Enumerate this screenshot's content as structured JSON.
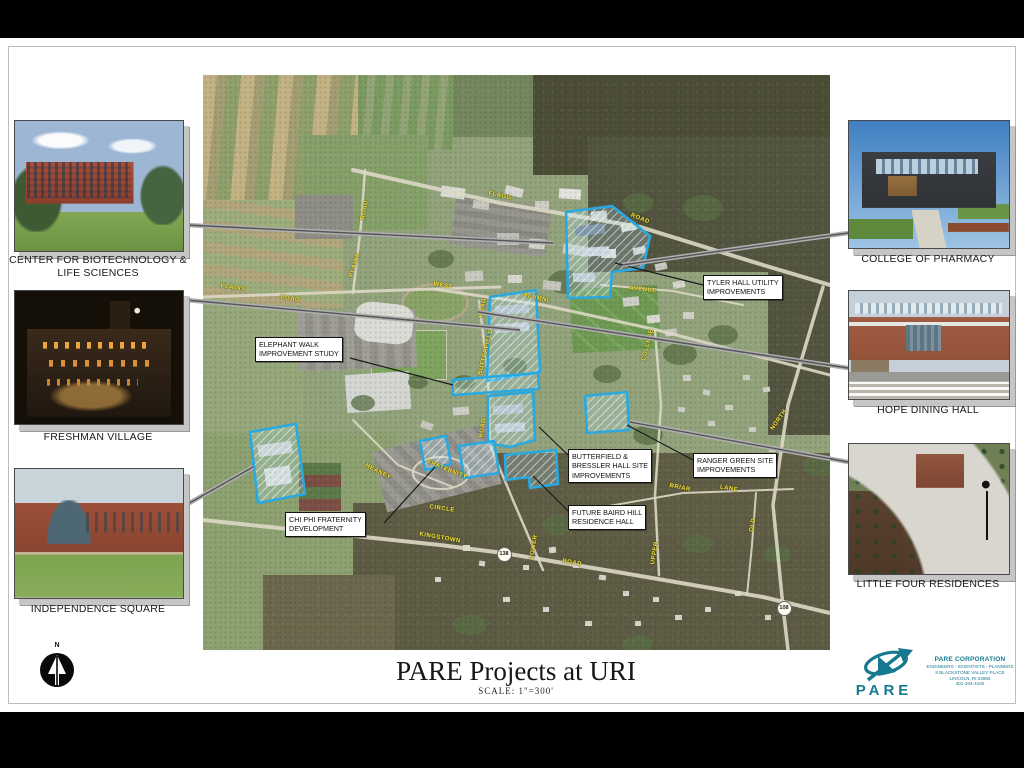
{
  "poster": {
    "title": "PARE Projects at URI",
    "scale_note": "SCALE: 1\"=300'"
  },
  "north_arrow": {
    "label": "N"
  },
  "brand": {
    "name": "PARE",
    "company": "PARE CORPORATION",
    "tagline": "ENGINEERS - SCIENTISTS - PLANNERS",
    "address": "8 BLACKSTONE VALLEY PLACE",
    "city": "LINCOLN, RI 02865",
    "phone": "401-334-4100",
    "color": "#17798f"
  },
  "photos": [
    {
      "id": "biotech",
      "caption": "CENTER FOR BIOTECHNOLOGY & LIFE SCIENCES",
      "x": 14,
      "y": 120,
      "w": 168,
      "h": 130,
      "cy": 254
    },
    {
      "id": "freshman",
      "caption": "FRESHMAN VILLAGE",
      "x": 14,
      "y": 290,
      "w": 168,
      "h": 133,
      "cy": 431
    },
    {
      "id": "independence",
      "caption": "INDEPENDENCE SQUARE",
      "x": 14,
      "y": 468,
      "w": 168,
      "h": 129,
      "cy": 603
    },
    {
      "id": "pharmacy",
      "caption": "COLLEGE OF PHARMACY",
      "x": 848,
      "y": 120,
      "w": 160,
      "h": 127,
      "cy": 253
    },
    {
      "id": "hope",
      "caption": "HOPE DINING HALL",
      "x": 848,
      "y": 290,
      "w": 160,
      "h": 108,
      "cy": 404
    },
    {
      "id": "littlefour",
      "caption": "LITTLE FOUR RESIDENCES",
      "x": 848,
      "y": 443,
      "w": 160,
      "h": 130,
      "cy": 578
    }
  ],
  "map": {
    "x": 203,
    "y": 75,
    "w": 627,
    "h": 575,
    "site_color": "#2aa9e1",
    "sites": [
      {
        "name": "tyler-hall-site",
        "points": "363,137 409,131 447,161 440,193 409,197 407,222 365,223"
      },
      {
        "name": "quad-site",
        "points": "287,222 333,215 337,297 284,306"
      },
      {
        "name": "elephant-walk-strip-site",
        "points": "249,305 335,298 336,314 250,320"
      },
      {
        "name": "butterfield-bressler-site",
        "points": "285,321 330,317 332,365 307,372 285,368"
      },
      {
        "name": "ranger-green-site",
        "points": "382,321 424,317 426,355 384,358"
      },
      {
        "name": "independence-square-site",
        "points": "47,357 93,349 102,419 55,428"
      },
      {
        "name": "chi-phi-site",
        "points": "217,366 243,361 248,389 222,395"
      },
      {
        "name": "small-site-east",
        "points": "256,371 291,366 296,398 261,403"
      },
      {
        "name": "baird-hill-site",
        "points": "302,380 353,375 355,409 327,413 326,402 303,405"
      }
    ],
    "callouts": [
      {
        "id": "tyler-hall",
        "x": 500,
        "y": 200,
        "lines": [
          "TYLER HALL UTILITY",
          "IMPROVEMENTS"
        ],
        "leader": [
          500,
          210,
          412,
          188
        ]
      },
      {
        "id": "elephant-walk",
        "x": 52,
        "y": 262,
        "lines": [
          "ELEPHANT WALK",
          "IMPROVEMENT STUDY"
        ],
        "leader": [
          147,
          283,
          250,
          310
        ]
      },
      {
        "id": "butterfield-bressler",
        "x": 365,
        "y": 374,
        "lines": [
          "BUTTERFIELD &",
          "BRESSLER HALL SITE",
          "IMPROVEMENTS"
        ],
        "leader": [
          365,
          380,
          336,
          352
        ]
      },
      {
        "id": "ranger-green",
        "x": 490,
        "y": 378,
        "lines": [
          "RANGER GREEN SITE",
          "IMPROVEMENTS"
        ],
        "leader": [
          490,
          385,
          424,
          350
        ]
      },
      {
        "id": "future-baird-hill",
        "x": 365,
        "y": 430,
        "lines": [
          "FUTURE BAIRD HILL",
          "RESIDENCE HALL"
        ],
        "leader": [
          365,
          436,
          330,
          401
        ]
      },
      {
        "id": "chi-phi",
        "x": 82,
        "y": 437,
        "lines": [
          "CHI PHI FRATERNITY",
          "DEVELOPMENT"
        ],
        "leader": [
          181,
          448,
          232,
          392
        ]
      }
    ],
    "road_labels": [
      {
        "t": "FLAGG",
        "x": 297,
        "y": 121,
        "r": 12
      },
      {
        "t": "ROAD",
        "x": 437,
        "y": 144,
        "r": 22
      },
      {
        "t": "ROAD",
        "x": 162,
        "y": 135,
        "r": -78
      },
      {
        "t": "PLAINS",
        "x": 152,
        "y": 190,
        "r": -72
      },
      {
        "t": "PLAINS",
        "x": 30,
        "y": 213,
        "r": 8
      },
      {
        "t": "ROAD",
        "x": 87,
        "y": 224,
        "r": 8
      },
      {
        "t": "WEST",
        "x": 240,
        "y": 211,
        "r": 10
      },
      {
        "t": "ALUMNI",
        "x": 333,
        "y": 223,
        "r": 14
      },
      {
        "t": "ROAD",
        "x": 280,
        "y": 233,
        "r": -80
      },
      {
        "t": "AVENUE",
        "x": 440,
        "y": 215,
        "r": 6
      },
      {
        "t": "BUTTERFIELD",
        "x": 283,
        "y": 277,
        "r": -76
      },
      {
        "t": "COLLEGE",
        "x": 445,
        "y": 270,
        "r": -75
      },
      {
        "t": "ROAD",
        "x": 280,
        "y": 353,
        "r": -80
      },
      {
        "t": "HEANEY",
        "x": 175,
        "y": 397,
        "r": 28
      },
      {
        "t": "FRATERNITY",
        "x": 244,
        "y": 395,
        "r": 22
      },
      {
        "t": "CIRCLE",
        "x": 239,
        "y": 434,
        "r": 8
      },
      {
        "t": "KINGSTOWN",
        "x": 237,
        "y": 463,
        "r": 10
      },
      {
        "t": "ROAD",
        "x": 369,
        "y": 488,
        "r": 10
      },
      {
        "t": "LOWER",
        "x": 331,
        "y": 472,
        "r": -80
      },
      {
        "t": "UPPER",
        "x": 452,
        "y": 478,
        "r": -80
      },
      {
        "t": "NORTH",
        "x": 576,
        "y": 345,
        "r": -55
      },
      {
        "t": "BRIAR",
        "x": 477,
        "y": 413,
        "r": 12
      },
      {
        "t": "LANE",
        "x": 526,
        "y": 414,
        "r": 10
      },
      {
        "t": "OLD",
        "x": 550,
        "y": 450,
        "r": -80
      }
    ],
    "shields": [
      {
        "label": "138",
        "x": 300,
        "y": 478
      },
      {
        "label": "108",
        "x": 580,
        "y": 532
      }
    ],
    "leader_bars": [
      {
        "x1": 186,
        "y1": 225,
        "x2": 553,
        "y2": 243
      },
      {
        "x1": 186,
        "y1": 300,
        "x2": 520,
        "y2": 330
      },
      {
        "x1": 186,
        "y1": 505,
        "x2": 253,
        "y2": 467
      },
      {
        "x1": 848,
        "y1": 233,
        "x2": 622,
        "y2": 265
      },
      {
        "x1": 848,
        "y1": 368,
        "x2": 478,
        "y2": 312
      },
      {
        "x1": 848,
        "y1": 462,
        "x2": 630,
        "y2": 422
      }
    ]
  }
}
